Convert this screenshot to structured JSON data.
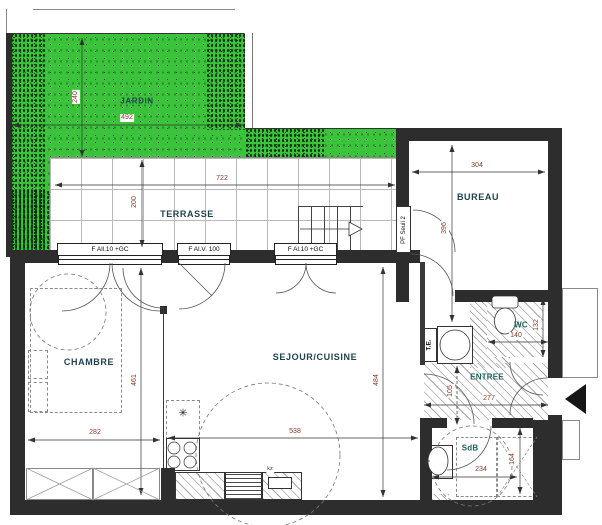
{
  "colors": {
    "garden_green": "#3cc33c",
    "wall_dark": "#2d2d2d",
    "dimension_text": "#8b3a26",
    "room_label": "#1f4250",
    "wet_room_label": "#176158"
  },
  "rooms": {
    "jardin": {
      "label": "JARDIN",
      "width": "492",
      "height": "240"
    },
    "terrasse": {
      "label": "TERRASSE",
      "width": "722",
      "height": "200"
    },
    "bureau": {
      "label": "BUREAU",
      "width": "304",
      "height": "396"
    },
    "chambre": {
      "label": "CHAMBRE",
      "width": "282",
      "height": "461"
    },
    "sejour_cuisine": {
      "label": "SEJOUR/CUISINE",
      "width": "538",
      "height": "484"
    },
    "entree": {
      "label": "ENTREE",
      "width": "277",
      "height": "105"
    },
    "wc": {
      "label": "WC",
      "width": "140",
      "height": "132"
    },
    "sdb": {
      "label": "SdB",
      "width": "234",
      "height": "164"
    },
    "technical": {
      "label": "T.E."
    }
  },
  "openings": {
    "chambre_window": "F All.10 +GC",
    "sejour_window": "F Al.V. 100",
    "sejour_door_window": "F Al.10 +GC",
    "bureau_terrace_door": "PF Seuil 2"
  },
  "kitchen": {
    "sink_label": "kz",
    "fridge_symbol": "✳"
  }
}
